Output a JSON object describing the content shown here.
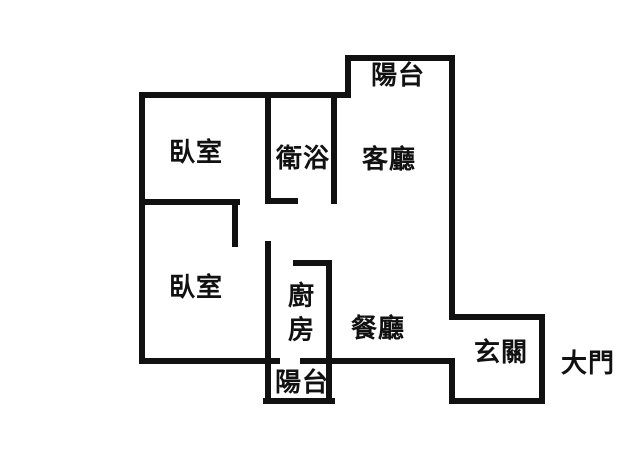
{
  "floor_plan": {
    "type": "apartment-floor-plan",
    "wall_color": "#111111",
    "text_color": "#111111",
    "background_color": "#ffffff",
    "rooms": [
      {
        "id": "balcony-top",
        "label": "陽台"
      },
      {
        "id": "bedroom-1",
        "label": "臥室"
      },
      {
        "id": "bathroom",
        "label": "衛浴"
      },
      {
        "id": "living-room",
        "label": "客廳"
      },
      {
        "id": "bedroom-2",
        "label": "臥室"
      },
      {
        "id": "kitchen",
        "label": "廚房"
      },
      {
        "id": "dining-room",
        "label": "餐廳"
      },
      {
        "id": "balcony-bottom",
        "label": "陽台"
      },
      {
        "id": "entryway",
        "label": "玄關"
      },
      {
        "id": "main-door",
        "label": "大門"
      }
    ]
  }
}
